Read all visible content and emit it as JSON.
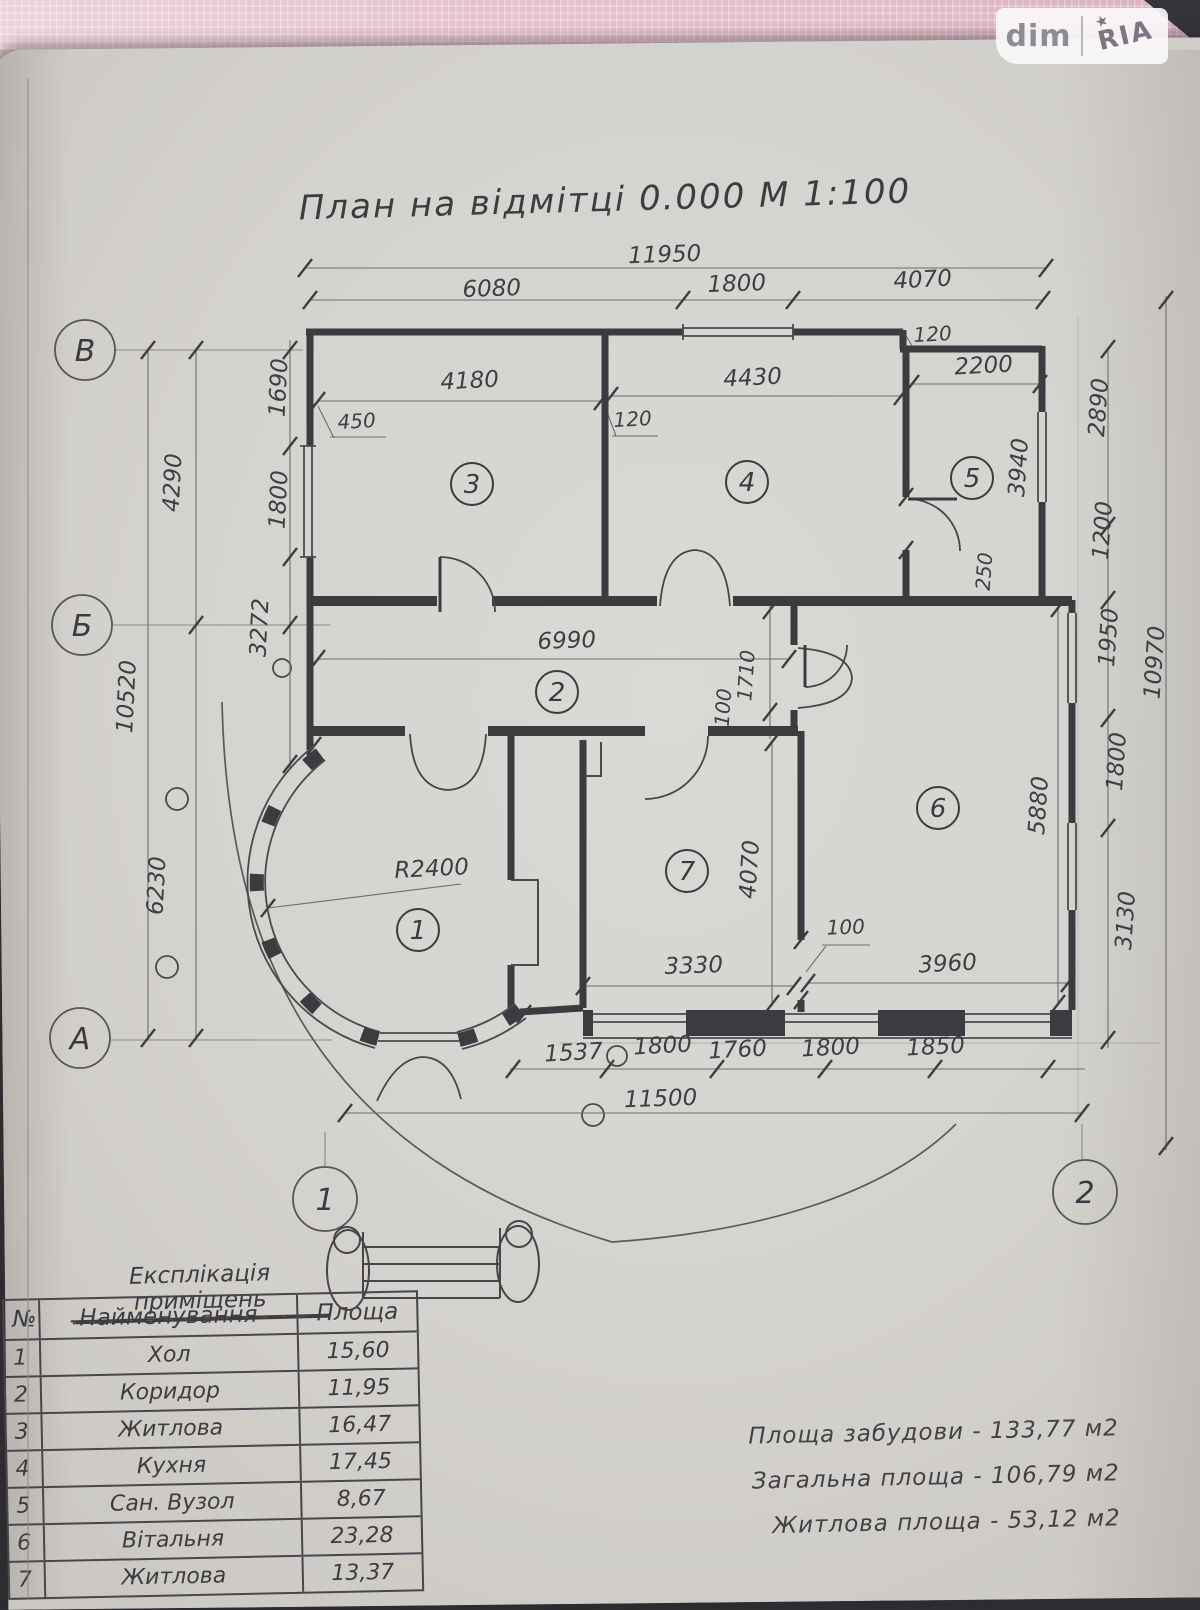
{
  "watermark": {
    "dim": "dim",
    "ria": "RIA",
    "star": "★"
  },
  "title": "План на відмітці 0.000 М 1:100",
  "legend": {
    "title": "Експлікація приміщень"
  },
  "table": {
    "headers": [
      "№",
      "Найменування",
      "Площа"
    ],
    "rows": [
      [
        "1",
        "Хол",
        "15,60"
      ],
      [
        "2",
        "Коридор",
        "11,95"
      ],
      [
        "3",
        "Житлова",
        "16,47"
      ],
      [
        "4",
        "Кухня",
        "17,45"
      ],
      [
        "5",
        "Сан. Вузол",
        "8,67"
      ],
      [
        "6",
        "Вітальня",
        "23,28"
      ],
      [
        "7",
        "Житлова",
        "13,37"
      ]
    ]
  },
  "summary": [
    "Площа забудови - 133,77 м2",
    "Загальна площа - 106,79 м2",
    "Житлова площа - 53,12 м2"
  ],
  "plan": {
    "scale_note": "М 1:100",
    "dimensions": [
      {
        "t": "11950",
        "x": 665,
        "y": 262,
        "r": -2
      },
      {
        "t": "6080",
        "x": 492,
        "y": 296,
        "r": -2
      },
      {
        "t": "1800",
        "x": 737,
        "y": 291,
        "r": -2
      },
      {
        "t": "4070",
        "x": 923,
        "y": 287,
        "r": -3
      },
      {
        "t": "4180",
        "x": 470,
        "y": 388,
        "r": -3
      },
      {
        "t": "450",
        "x": 357,
        "y": 428,
        "r": -3,
        "s": 1
      },
      {
        "t": "120",
        "x": 633,
        "y": 426,
        "r": -3,
        "s": 1
      },
      {
        "t": "4430",
        "x": 753,
        "y": 385,
        "r": -3
      },
      {
        "t": "120",
        "x": 933,
        "y": 341,
        "r": -3,
        "s": 1
      },
      {
        "t": "2200",
        "x": 984,
        "y": 373,
        "r": -3
      },
      {
        "t": "2890",
        "x": 1106,
        "y": 408,
        "r": -86
      },
      {
        "t": "3940",
        "x": 1026,
        "y": 468,
        "r": -86
      },
      {
        "t": "1200",
        "x": 1110,
        "y": 531,
        "r": -86
      },
      {
        "t": "250",
        "x": 991,
        "y": 572,
        "r": -86,
        "s": 1
      },
      {
        "t": "1950",
        "x": 1116,
        "y": 638,
        "r": -86
      },
      {
        "t": "10970",
        "x": 1162,
        "y": 663,
        "r": -86
      },
      {
        "t": "1800",
        "x": 1124,
        "y": 762,
        "r": -86
      },
      {
        "t": "5880",
        "x": 1046,
        "y": 806,
        "r": -86
      },
      {
        "t": "3130",
        "x": 1133,
        "y": 921,
        "r": -86
      },
      {
        "t": "1690",
        "x": 286,
        "y": 388,
        "r": -87
      },
      {
        "t": "1800",
        "x": 286,
        "y": 500,
        "r": -87
      },
      {
        "t": "4290",
        "x": 180,
        "y": 483,
        "r": -87
      },
      {
        "t": "3272",
        "x": 267,
        "y": 628,
        "r": -87
      },
      {
        "t": "10520",
        "x": 134,
        "y": 697,
        "r": -87
      },
      {
        "t": "6230",
        "x": 164,
        "y": 886,
        "r": -87
      },
      {
        "t": "6990",
        "x": 567,
        "y": 648,
        "r": -2
      },
      {
        "t": "1710",
        "x": 753,
        "y": 676,
        "r": -86,
        "s": 1
      },
      {
        "t": "100",
        "x": 730,
        "y": 708,
        "r": -86,
        "s": 1
      },
      {
        "t": "R2400",
        "x": 432,
        "y": 876,
        "r": -3
      },
      {
        "t": "4070",
        "x": 757,
        "y": 870,
        "r": -86
      },
      {
        "t": "100",
        "x": 846,
        "y": 934,
        "r": -2,
        "s": 1
      },
      {
        "t": "3330",
        "x": 694,
        "y": 973,
        "r": -2
      },
      {
        "t": "3960",
        "x": 948,
        "y": 971,
        "r": -3
      },
      {
        "t": "1537",
        "x": 574,
        "y": 1060,
        "r": -3
      },
      {
        "t": "1800",
        "x": 663,
        "y": 1053,
        "r": -3
      },
      {
        "t": "1760",
        "x": 738,
        "y": 1057,
        "r": -3
      },
      {
        "t": "1800",
        "x": 831,
        "y": 1055,
        "r": -3
      },
      {
        "t": "1850",
        "x": 936,
        "y": 1054,
        "r": -3
      },
      {
        "t": "11500",
        "x": 661,
        "y": 1106,
        "r": -2
      }
    ],
    "rooms": [
      {
        "n": "1",
        "x": 418,
        "y": 930
      },
      {
        "n": "2",
        "x": 557,
        "y": 692
      },
      {
        "n": "3",
        "x": 472,
        "y": 484
      },
      {
        "n": "4",
        "x": 747,
        "y": 482
      },
      {
        "n": "5",
        "x": 972,
        "y": 478
      },
      {
        "n": "6",
        "x": 938,
        "y": 808
      },
      {
        "n": "7",
        "x": 687,
        "y": 871
      }
    ],
    "grid": [
      {
        "label": "В",
        "x": 85,
        "y": 350,
        "rad": 30
      },
      {
        "label": "Б",
        "x": 82,
        "y": 625,
        "rad": 30
      },
      {
        "label": "А",
        "x": 80,
        "y": 1038,
        "rad": 30
      },
      {
        "label": "1",
        "x": 325,
        "y": 1199,
        "rad": 32
      },
      {
        "label": "2",
        "x": 1085,
        "y": 1192,
        "rad": 32
      }
    ]
  }
}
